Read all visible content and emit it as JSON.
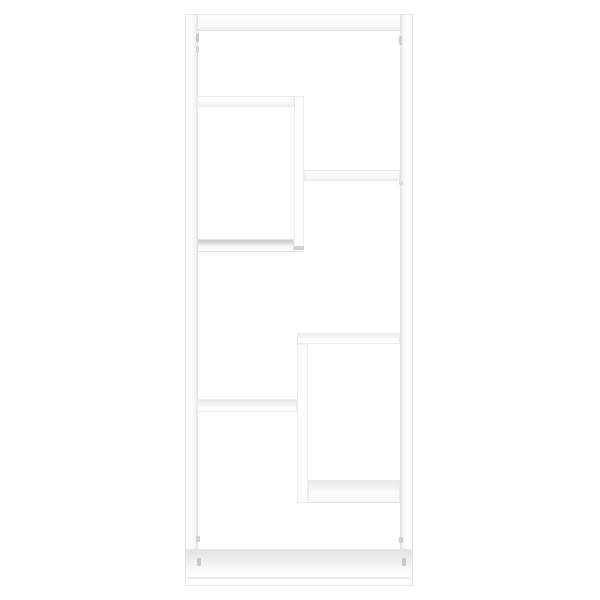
{
  "scene": {
    "description": "Product photo of a white geometric cube wall shelf with staggered zig-zag compartments, viewed straight on against a plain white background",
    "background_color": "#ffffff",
    "furniture_color": "#ffffff",
    "edge_color": "#e8e8e8",
    "shade_light": "#ededed",
    "shadow_color": "#c9c9c9"
  },
  "shelf": {
    "outer_frame": {
      "x": 185,
      "y": 14,
      "width": 228,
      "height": 572
    },
    "parts": [
      {
        "name": "frame-top-rail",
        "x": 185,
        "y": 14,
        "w": 228,
        "h": 17,
        "shade": "top-rail",
        "frame": true
      },
      {
        "name": "frame-left-panel",
        "x": 185,
        "y": 14,
        "w": 13,
        "h": 572,
        "shade": "inner-right",
        "frame": true
      },
      {
        "name": "frame-right-panel",
        "x": 400,
        "y": 14,
        "w": 13,
        "h": 572,
        "shade": "inner-left",
        "frame": true
      },
      {
        "name": "frame-bottom-rail",
        "x": 185,
        "y": 549,
        "w": 228,
        "h": 37,
        "shade": "floor",
        "frame": true
      },
      {
        "name": "top-left-shelf",
        "x": 197,
        "y": 96,
        "w": 97,
        "h": 11,
        "shade": "under"
      },
      {
        "name": "upper-divider",
        "x": 294,
        "y": 96,
        "w": 10,
        "h": 156,
        "shade": "flat"
      },
      {
        "name": "upper-right-shelf",
        "x": 304,
        "y": 170,
        "w": 96,
        "h": 11,
        "shade": "under"
      },
      {
        "name": "mid-left-shelf",
        "x": 197,
        "y": 239,
        "w": 97,
        "h": 13,
        "shade": "under-dark"
      },
      {
        "name": "mid-right-shelf",
        "x": 297,
        "y": 333,
        "w": 103,
        "h": 11,
        "shade": "top-lite"
      },
      {
        "name": "lower-divider",
        "x": 297,
        "y": 344,
        "w": 11,
        "h": 159,
        "shade": "flat"
      },
      {
        "name": "lower-left-shelf",
        "x": 197,
        "y": 399,
        "w": 100,
        "h": 13,
        "shade": "top"
      },
      {
        "name": "lower-right-shelf",
        "x": 308,
        "y": 480,
        "w": 92,
        "h": 23,
        "shade": "top-big"
      }
    ],
    "marks": [
      {
        "name": "cam-hole-left-top-1",
        "x": 196,
        "y": 33,
        "w": 3,
        "h": 9,
        "color": "#cccccc"
      },
      {
        "name": "cam-hole-left-top-2",
        "x": 196,
        "y": 46,
        "w": 3,
        "h": 7,
        "color": "#d6d6d6"
      },
      {
        "name": "cam-hole-right-top",
        "x": 399,
        "y": 36,
        "w": 3,
        "h": 9,
        "color": "#cccccc"
      },
      {
        "name": "joint-shadow-upper-right",
        "x": 399,
        "y": 181,
        "w": 4,
        "h": 4,
        "color": "#dddddd"
      },
      {
        "name": "divider-foot-shadow",
        "x": 294,
        "y": 246,
        "w": 10,
        "h": 4,
        "color": "#d2d2d2"
      },
      {
        "name": "cam-hole-left-bottom-1",
        "x": 196,
        "y": 536,
        "w": 4,
        "h": 6,
        "color": "#cfcfcf"
      },
      {
        "name": "cam-hole-left-bottom-2",
        "x": 197,
        "y": 558,
        "w": 4,
        "h": 8,
        "color": "#c9c9c9"
      },
      {
        "name": "cam-hole-right-bottom-1",
        "x": 399,
        "y": 537,
        "w": 4,
        "h": 6,
        "color": "#cfcfcf"
      },
      {
        "name": "cam-hole-right-bottom-2",
        "x": 402,
        "y": 558,
        "w": 4,
        "h": 8,
        "color": "#c9c9c9"
      },
      {
        "name": "bottom-front-edge-line",
        "x": 187,
        "y": 577,
        "w": 224,
        "h": 2,
        "color": "#ededed"
      }
    ]
  }
}
